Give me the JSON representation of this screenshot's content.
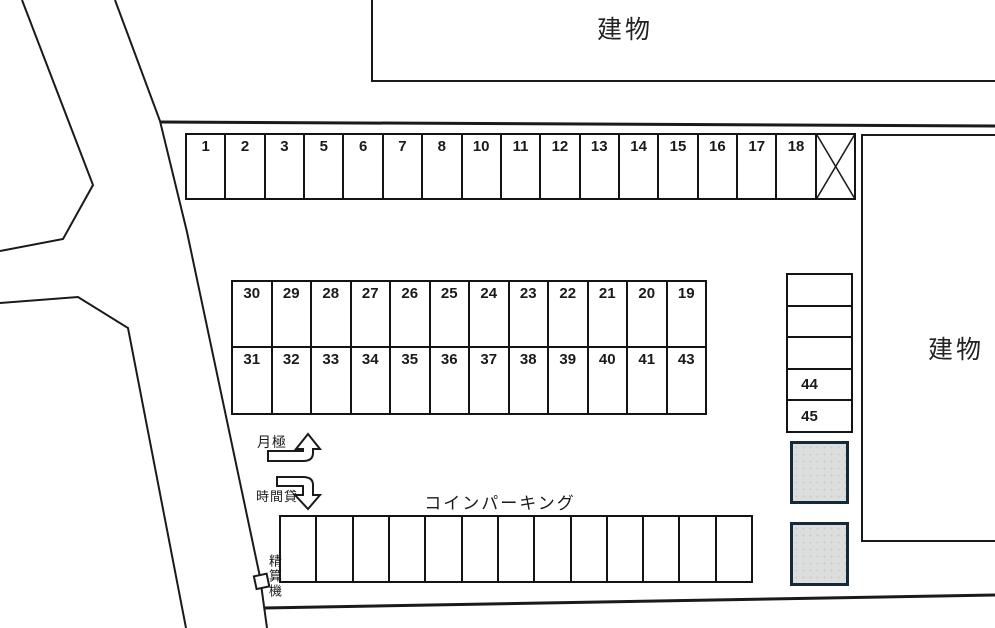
{
  "diagram": {
    "kind": "parking-lot-layout"
  },
  "buildings": {
    "top_label": "建物",
    "right_label": "建物"
  },
  "labels": {
    "monthly": "月極",
    "hourly": "時間貸",
    "coin_parking": "コインパーキング",
    "payment_machine": "精算機"
  },
  "parking": {
    "top_row": [
      "1",
      "2",
      "3",
      "5",
      "6",
      "7",
      "8",
      "10",
      "11",
      "12",
      "13",
      "14",
      "15",
      "16",
      "17",
      "18"
    ],
    "top_row_blocked_space": "X",
    "middle_upper": [
      "30",
      "29",
      "28",
      "27",
      "26",
      "25",
      "24",
      "23",
      "22",
      "21",
      "20",
      "19"
    ],
    "middle_lower": [
      "31",
      "32",
      "33",
      "34",
      "35",
      "36",
      "37",
      "38",
      "39",
      "40",
      "41",
      "43"
    ],
    "side_column": [
      "",
      "",
      "",
      "44",
      "45"
    ],
    "coin_spaces_count": 13
  },
  "colors": {
    "line": "#1a1a1a",
    "block_fill": "#dcdedd",
    "block_border": "#14293a"
  }
}
